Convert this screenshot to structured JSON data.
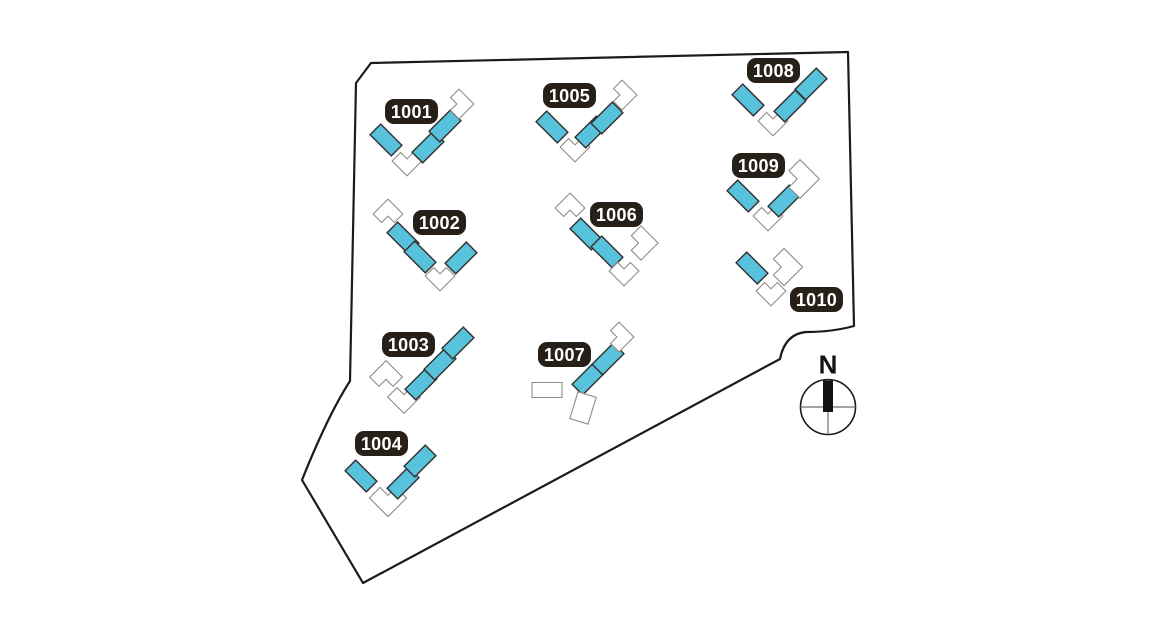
{
  "canvas": {
    "width": 1160,
    "height": 640,
    "background": "#ffffff"
  },
  "colors": {
    "unit_fill": "#58c1dc",
    "unit_stroke": "#33302d",
    "vacant_fill": "#ffffff",
    "vacant_stroke": "#8f8c89",
    "boundary_stroke": "#1d1a18",
    "label_bg": "#262019",
    "label_text": "#ffffff",
    "compass_stroke": "#1d1a18",
    "compass_cross": "#6e6e6e",
    "compass_needle": "#16120f"
  },
  "site": {
    "boundary_path": "M 371 63 L 848 52 L 854 326 Q 832 332 806 332 Q 785 334 780 359 L 363 583 L 302 480 Q 328 415 350 381 L 356 83 Z",
    "compass": {
      "label": "N",
      "cx": 828,
      "cy": 407,
      "r": 27.5
    }
  },
  "buildings": [
    {
      "id": "1001",
      "label": "1001",
      "pill": {
        "x": 385,
        "y": 99
      },
      "segments": [
        {
          "t": "unit",
          "x": 386,
          "y": 140,
          "r": 45
        },
        {
          "t": "elbow",
          "x": 407,
          "y": 161,
          "r": -135
        },
        {
          "t": "unit",
          "x": 428,
          "y": 147,
          "r": -45
        },
        {
          "t": "unit",
          "x": 445,
          "y": 126,
          "r": -45
        },
        {
          "t": "elbow",
          "x": 459,
          "y": 104,
          "r": 135
        }
      ]
    },
    {
      "id": "1002",
      "label": "1002",
      "pill": {
        "x": 413,
        "y": 210
      },
      "segments": [
        {
          "t": "elbow",
          "x": 388,
          "y": 214,
          "r": 45
        },
        {
          "t": "unit",
          "x": 403,
          "y": 238,
          "r": 45
        },
        {
          "t": "unit",
          "x": 420,
          "y": 257,
          "r": 45
        },
        {
          "t": "elbow",
          "x": 440,
          "y": 276,
          "r": -135
        },
        {
          "t": "unit",
          "x": 461,
          "y": 258,
          "r": -45
        }
      ]
    },
    {
      "id": "1003",
      "label": "1003",
      "pill": {
        "x": 382,
        "y": 332
      },
      "segments": [
        {
          "t": "elbow",
          "x": 386,
          "y": 377,
          "r": 45,
          "s": 1.1
        },
        {
          "t": "elbow",
          "x": 404,
          "y": 397,
          "r": -135,
          "s": 1.1
        },
        {
          "t": "unit",
          "x": 421,
          "y": 384,
          "r": -45
        },
        {
          "t": "unit",
          "x": 440,
          "y": 364,
          "r": -45
        },
        {
          "t": "unit",
          "x": 458,
          "y": 343,
          "r": -45
        }
      ]
    },
    {
      "id": "1004",
      "label": "1004",
      "pill": {
        "x": 355,
        "y": 431
      },
      "segments": [
        {
          "t": "unit",
          "x": 361,
          "y": 476,
          "r": 45
        },
        {
          "t": "elbow",
          "x": 388,
          "y": 498,
          "r": -135,
          "s": 1.25
        },
        {
          "t": "unit",
          "x": 403,
          "y": 483,
          "r": -45
        },
        {
          "t": "unit",
          "x": 420,
          "y": 461,
          "r": -45
        }
      ]
    },
    {
      "id": "1005",
      "label": "1005",
      "pill": {
        "x": 543,
        "y": 83
      },
      "segments": [
        {
          "t": "unit",
          "x": 552,
          "y": 127,
          "r": 45
        },
        {
          "t": "elbow",
          "x": 575,
          "y": 147,
          "r": -135
        },
        {
          "t": "unit",
          "x": 591,
          "y": 132,
          "r": -45
        },
        {
          "t": "unit",
          "x": 607,
          "y": 118,
          "r": -45
        },
        {
          "t": "elbow",
          "x": 622,
          "y": 95,
          "r": 135
        }
      ]
    },
    {
      "id": "1006",
      "label": "1006",
      "pill": {
        "x": 590,
        "y": 202
      },
      "segments": [
        {
          "t": "elbow",
          "x": 570,
          "y": 208,
          "r": 45
        },
        {
          "t": "unit",
          "x": 586,
          "y": 234,
          "r": 45
        },
        {
          "t": "unit",
          "x": 607,
          "y": 252,
          "r": 45
        },
        {
          "t": "elbow",
          "x": 624,
          "y": 271,
          "r": -135
        },
        {
          "t": "elbow",
          "x": 641,
          "y": 243,
          "r": 135,
          "s": 1.15
        }
      ]
    },
    {
      "id": "1007",
      "label": "1007",
      "pill": {
        "x": 538,
        "y": 342
      },
      "segments": [
        {
          "t": "unit",
          "x": 588,
          "y": 379,
          "r": -45
        },
        {
          "t": "unit",
          "x": 608,
          "y": 359,
          "r": -45
        },
        {
          "t": "elbow",
          "x": 619,
          "y": 337,
          "r": 135
        },
        {
          "t": "wrect",
          "x": 547,
          "y": 390,
          "r": 0,
          "w": 30,
          "h": 15
        },
        {
          "t": "wrect",
          "x": 583,
          "y": 408,
          "r": 17,
          "w": 19,
          "h": 28
        }
      ]
    },
    {
      "id": "1008",
      "label": "1008",
      "pill": {
        "x": 747,
        "y": 58
      },
      "segments": [
        {
          "t": "unit",
          "x": 748,
          "y": 100,
          "r": 45
        },
        {
          "t": "elbow",
          "x": 773,
          "y": 121,
          "r": -135
        },
        {
          "t": "unit",
          "x": 790,
          "y": 106,
          "r": -45
        },
        {
          "t": "unit",
          "x": 811,
          "y": 84,
          "r": -45
        }
      ]
    },
    {
      "id": "1009",
      "label": "1009",
      "pill": {
        "x": 732,
        "y": 153
      },
      "segments": [
        {
          "t": "unit",
          "x": 743,
          "y": 196,
          "r": 45
        },
        {
          "t": "elbow",
          "x": 768,
          "y": 216,
          "r": -135
        },
        {
          "t": "unit",
          "x": 784,
          "y": 201,
          "r": -45
        },
        {
          "t": "elbow",
          "x": 800,
          "y": 179,
          "r": 135,
          "s": 1.3
        }
      ]
    },
    {
      "id": "1010",
      "label": "1010",
      "pill": {
        "x": 790,
        "y": 287
      },
      "segments": [
        {
          "t": "unit",
          "x": 752,
          "y": 268,
          "r": 45
        },
        {
          "t": "elbow",
          "x": 771,
          "y": 291,
          "r": -135
        },
        {
          "t": "elbow",
          "x": 784,
          "y": 267,
          "r": 135,
          "s": 1.25
        }
      ]
    }
  ],
  "pill": {
    "w": 53,
    "h": 25,
    "radius": 9
  }
}
